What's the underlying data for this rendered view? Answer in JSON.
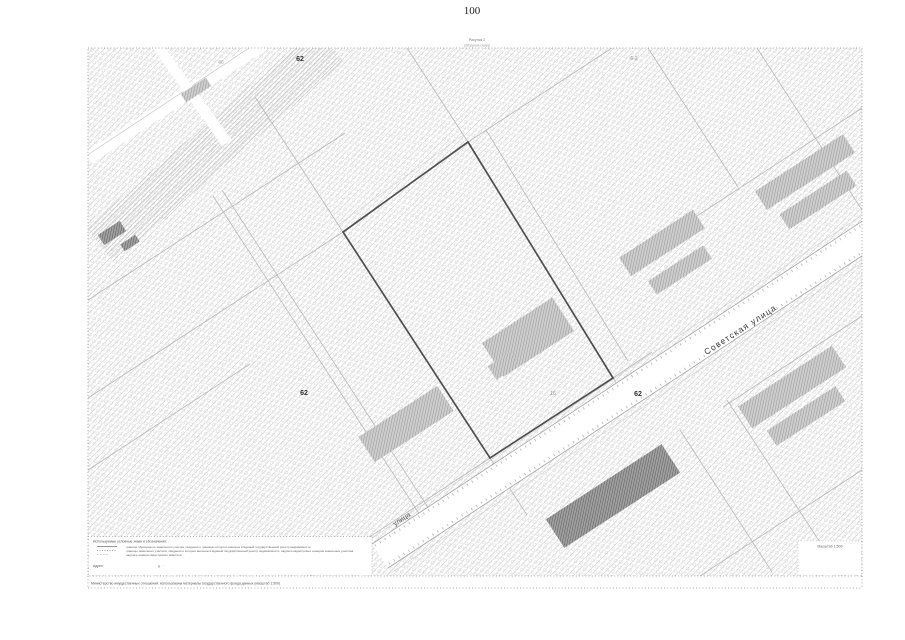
{
  "page": {
    "number": "100"
  },
  "figure": {
    "caption_title": "Рисунок 2",
    "caption_subtitle": "(Обзорная схема)"
  },
  "map": {
    "street_main": "Советская улица",
    "street_secondary": "улица",
    "number_top": "62",
    "number_left": "62",
    "number_road": "62",
    "number_block_faint": "46",
    "number_topright_faint": "6-2",
    "parcel_faint": "16",
    "scale_note": "Масштаб 1:500"
  },
  "legend": {
    "title": "Используемые условные знаки и обозначения:",
    "items": [
      {
        "text": "граница образуемого земельного участка, сведения о границах которого внесены в Единый государственный реестр недвижимости"
      },
      {
        "text": "границы земельных участков, сведения о которых внесены в Единый государственный реестр недвижимости, надписи кадастровых номеров земельных участков"
      },
      {
        "text": "надпись номера кадастрового квартала"
      }
    ],
    "address_label": "Адрес",
    "address_dots": "д.      ·        ·"
  },
  "footer": {
    "note": "Министерство имущественных отношений: использованы материалы государственного фонда данных (масштаб 1:500)"
  },
  "colors": {
    "hatch": "#c9c9c9",
    "road_edge": "#a3a3a3",
    "parcel_outline": "#4f4f4f",
    "building": "#9a9a9a",
    "building_dark": "#5c5c5c"
  }
}
